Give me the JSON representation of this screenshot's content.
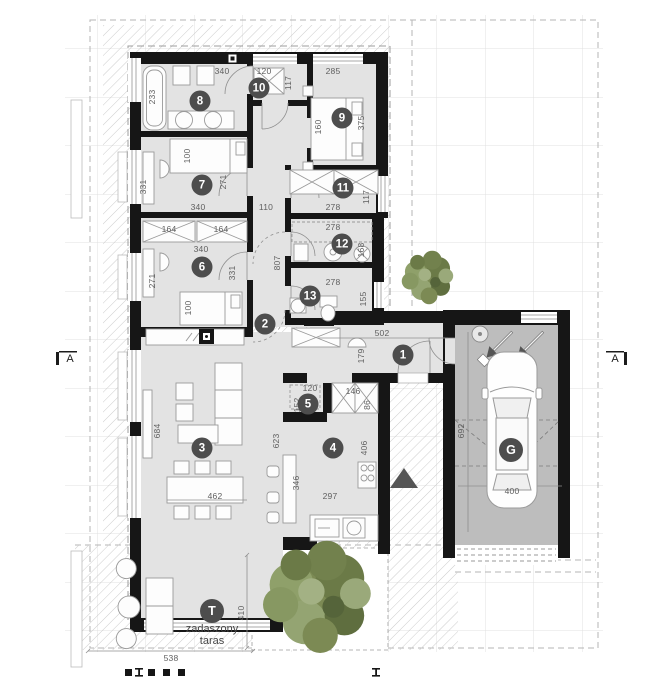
{
  "drawing": {
    "type_label": "floor plan",
    "terrace": {
      "badge": "T",
      "label_line1": "zadaszony",
      "label_line2": "taras"
    },
    "garage_badge": "G",
    "section_marker_left": "A",
    "section_marker_right": "A"
  },
  "colors": {
    "wall": "#161616",
    "room_floor": "#e3e3e3",
    "garage_floor": "#bdbdbd",
    "badge_bg": "#4d4d4d",
    "dim_text": "#5f5f5f",
    "grid_line": "#e0e0e0",
    "hatch_line": "#cdcdcd",
    "tree_green": "#7c8a54"
  },
  "badges": [
    {
      "t": "1",
      "x": 403,
      "y": 355,
      "name": "room-badge-1"
    },
    {
      "t": "2",
      "x": 265,
      "y": 324,
      "name": "room-badge-2"
    },
    {
      "t": "3",
      "x": 202,
      "y": 448,
      "name": "room-badge-3"
    },
    {
      "t": "4",
      "x": 333,
      "y": 448,
      "name": "room-badge-4"
    },
    {
      "t": "5",
      "x": 308,
      "y": 404,
      "name": "room-badge-5"
    },
    {
      "t": "6",
      "x": 202,
      "y": 267,
      "name": "room-badge-6"
    },
    {
      "t": "7",
      "x": 202,
      "y": 185,
      "name": "room-badge-7"
    },
    {
      "t": "8",
      "x": 200,
      "y": 101,
      "name": "room-badge-8"
    },
    {
      "t": "9",
      "x": 342,
      "y": 118,
      "name": "room-badge-9"
    },
    {
      "t": "10",
      "x": 259,
      "y": 88,
      "name": "room-badge-10"
    },
    {
      "t": "11",
      "x": 343,
      "y": 188,
      "name": "room-badge-11"
    },
    {
      "t": "12",
      "x": 342,
      "y": 244,
      "name": "room-badge-12"
    },
    {
      "t": "13",
      "x": 310,
      "y": 296,
      "name": "room-badge-13"
    },
    {
      "t": "G",
      "x": 511,
      "y": 450,
      "big": true,
      "name": "garage-badge"
    },
    {
      "t": "T",
      "x": 212,
      "y": 611,
      "big": true,
      "name": "terrace-badge"
    }
  ],
  "dims": [
    {
      "t": "340",
      "x": 222,
      "y": 71
    },
    {
      "t": "120",
      "x": 264,
      "y": 71
    },
    {
      "t": "285",
      "x": 333,
      "y": 71
    },
    {
      "t": "117",
      "x": 288,
      "y": 83,
      "v": 1
    },
    {
      "t": "233",
      "x": 152,
      "y": 97,
      "v": 1
    },
    {
      "t": "160",
      "x": 318,
      "y": 127,
      "v": 1
    },
    {
      "t": "375",
      "x": 361,
      "y": 123,
      "v": 1
    },
    {
      "t": "100",
      "x": 187,
      "y": 156,
      "v": 1
    },
    {
      "t": "331",
      "x": 143,
      "y": 187,
      "v": 1
    },
    {
      "t": "271",
      "x": 223,
      "y": 182,
      "v": 1
    },
    {
      "t": "340",
      "x": 198,
      "y": 207
    },
    {
      "t": "110",
      "x": 266,
      "y": 207
    },
    {
      "t": "278",
      "x": 333,
      "y": 207
    },
    {
      "t": "117",
      "x": 366,
      "y": 197,
      "v": 1
    },
    {
      "t": "164",
      "x": 169,
      "y": 229
    },
    {
      "t": "164",
      "x": 221,
      "y": 229
    },
    {
      "t": "340",
      "x": 201,
      "y": 249
    },
    {
      "t": "278",
      "x": 333,
      "y": 227
    },
    {
      "t": "168",
      "x": 361,
      "y": 250,
      "v": 1
    },
    {
      "t": "807",
      "x": 277,
      "y": 263,
      "v": 1
    },
    {
      "t": "271",
      "x": 152,
      "y": 281,
      "v": 1
    },
    {
      "t": "331",
      "x": 232,
      "y": 273,
      "v": 1
    },
    {
      "t": "100",
      "x": 188,
      "y": 308,
      "v": 1
    },
    {
      "t": "278",
      "x": 333,
      "y": 282
    },
    {
      "t": "155",
      "x": 363,
      "y": 299,
      "v": 1
    },
    {
      "t": "502",
      "x": 382,
      "y": 333
    },
    {
      "t": "179",
      "x": 361,
      "y": 356,
      "v": 1
    },
    {
      "t": "120",
      "x": 310,
      "y": 388
    },
    {
      "t": "146",
      "x": 353,
      "y": 391
    },
    {
      "t": "152",
      "x": 297,
      "y": 405,
      "v": 1
    },
    {
      "t": "86",
      "x": 367,
      "y": 405,
      "v": 1
    },
    {
      "t": "406",
      "x": 364,
      "y": 448,
      "v": 1
    },
    {
      "t": "623",
      "x": 276,
      "y": 441,
      "v": 1
    },
    {
      "t": "684",
      "x": 157,
      "y": 431,
      "v": 1
    },
    {
      "t": "462",
      "x": 215,
      "y": 496
    },
    {
      "t": "346",
      "x": 296,
      "y": 483,
      "v": 1
    },
    {
      "t": "297",
      "x": 330,
      "y": 496
    },
    {
      "t": "692",
      "x": 461,
      "y": 431,
      "v": 1
    },
    {
      "t": "400",
      "x": 512,
      "y": 491
    },
    {
      "t": "538",
      "x": 171,
      "y": 658
    },
    {
      "t": "410",
      "x": 241,
      "y": 613,
      "v": 1
    }
  ],
  "labels": [
    {
      "t": "zadaszony",
      "x": 212,
      "y": 629,
      "cls": "tlabel",
      "name": "terrace-label-line1"
    },
    {
      "t": "taras",
      "x": 212,
      "y": 641,
      "cls": "tlabel",
      "name": "terrace-label-line2"
    },
    {
      "t": "A",
      "x": 70,
      "y": 359,
      "cls": "alabel",
      "name": "section-marker-left-label"
    },
    {
      "t": "A",
      "x": 615,
      "y": 359,
      "cls": "alabel",
      "name": "section-marker-right-label"
    }
  ]
}
